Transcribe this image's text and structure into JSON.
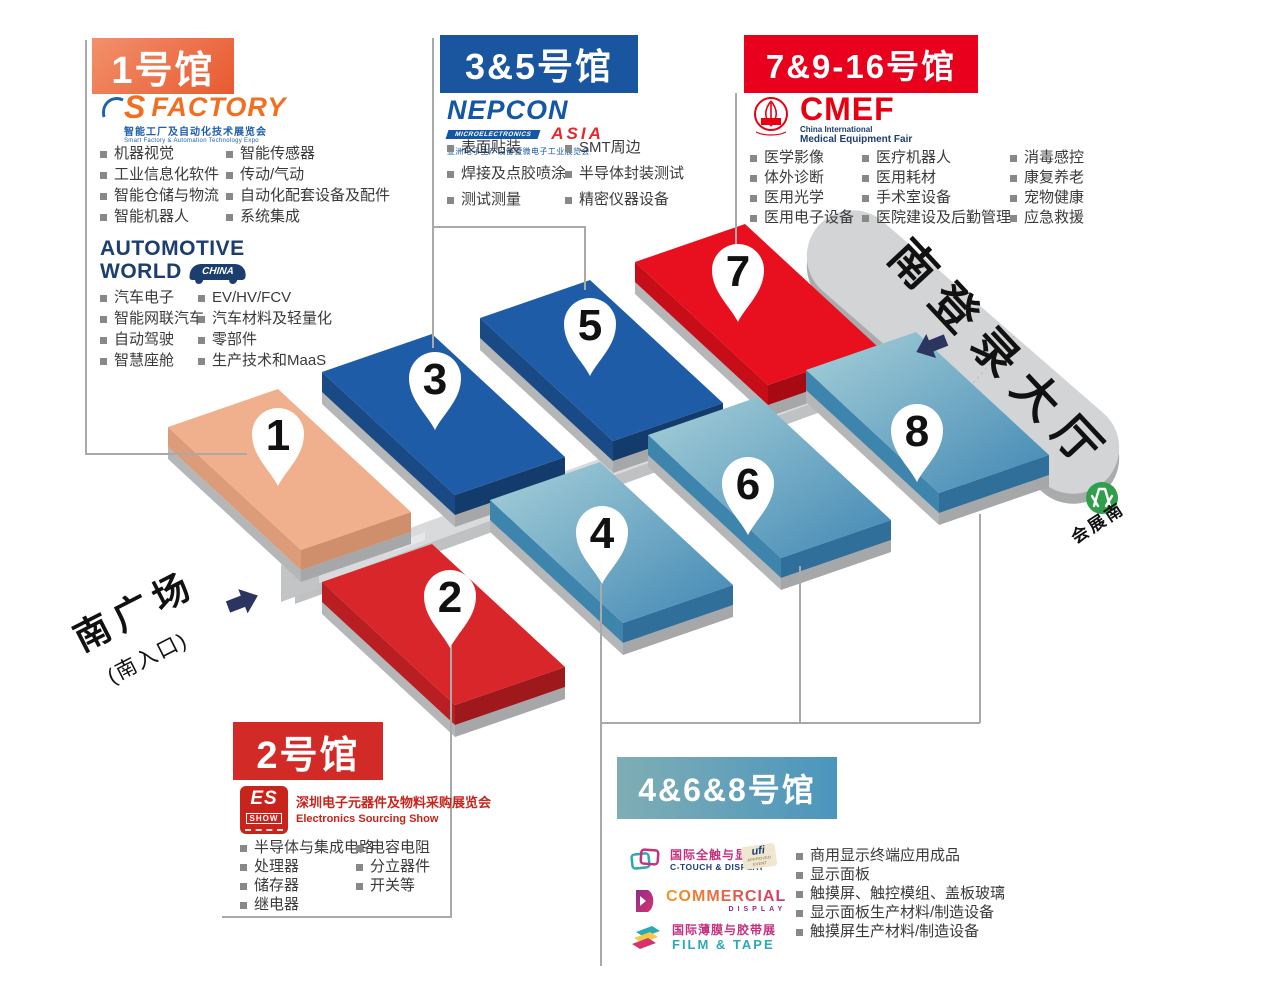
{
  "colors": {
    "hall1_accent": "#ED6A3E",
    "hall35_accent": "#1A55A0",
    "hall7916_accent": "#E8001C",
    "hall2_accent": "#D22A26",
    "hall468_accent": "#4B95BD",
    "hall1_block": "#F0B08D",
    "hall2_block": "#D8262B",
    "hall35_block": "#1F5CA7",
    "hall7_block": "#E8101E",
    "hall468_block": "#4187B4",
    "lobby_gray": "#D3D4D6",
    "metro_green": "#2F9E4D"
  },
  "map": {
    "pins": [
      "1",
      "2",
      "3",
      "4",
      "5",
      "6",
      "7",
      "8"
    ],
    "lobby_label": "南登录大厅",
    "plaza_label": "南广场",
    "plaza_sub_label": "(南入口)",
    "metro_label": "会展南"
  },
  "hall1": {
    "header": "1号馆",
    "sfactory": {
      "logo_s": "S",
      "logo_factory": "FACTORY",
      "sub_cn": "智能工厂及自动化技术展览会",
      "sub_en": "Smart Factory & Automation Technology Expo",
      "left": [
        "机器视觉",
        "工业信息化软件",
        "智能仓储与物流",
        "智能机器人"
      ],
      "right": [
        "智能传感器",
        "传动/气动",
        "自动化配套设备及配件",
        "系统集成"
      ]
    },
    "automotive": {
      "line1": "AUTOMOTIVE",
      "line2": "WORLD",
      "badge": "CHINA",
      "left": [
        "汽车电子",
        "智能网联汽车",
        "自动驾驶",
        "智慧座舱"
      ],
      "right": [
        "EV/HV/FCV",
        "汽车材料及轻量化",
        "零部件",
        "生产技术和MaaS"
      ]
    }
  },
  "hall35": {
    "header": "3&5号馆",
    "nepcon": {
      "name": "NEPCON",
      "band": "MICROELECTRONICS",
      "asia": "ASIA",
      "sub_cn": "亚洲电子生产设备暨微电子工业展览会"
    },
    "left": [
      "表面贴装",
      "焊接及点胶喷涂",
      "测试测量"
    ],
    "right": [
      "SMT周边",
      "半导体封装测试",
      "精密仪器设备"
    ]
  },
  "hall7916": {
    "header": "7&9-16号馆",
    "cmef": {
      "name": "CMEF",
      "sub1": "China International",
      "sub2": "Medical Equipment Fair"
    },
    "col1": [
      "医学影像",
      "体外诊断",
      "医用光学",
      "医用电子设备"
    ],
    "col2": [
      "医疗机器人",
      "医用耗材",
      "手术室设备",
      "医院建设及后勤管理"
    ],
    "col3": [
      "消毒感控",
      "康复养老",
      "宠物健康",
      "应急救援"
    ]
  },
  "hall2": {
    "header": "2号馆",
    "es": {
      "abbr": "ES",
      "show": "SHOW",
      "cn": "深圳电子元器件及物料采购展览会",
      "en": "Electronics Sourcing Show"
    },
    "left": [
      "半导体与集成电路",
      "处理器",
      "储存器",
      "继电器"
    ],
    "right": [
      "电容电阻",
      "分立器件",
      "开关等"
    ]
  },
  "hall468": {
    "header": "4&6&8号馆",
    "ctouch": {
      "cn": "国际全触与显示展",
      "en": "C-TOUCH & DISPLAY"
    },
    "ufi": {
      "name": "ufi",
      "sub": "APPROVED EVENT"
    },
    "commercial": {
      "name": "COMMERCIAL",
      "sub": "DISPLAY"
    },
    "film": {
      "cn": "国际薄膜与胶带展",
      "en": "FILM & TAPE"
    },
    "items": [
      "商用显示终端应用成品",
      "显示面板",
      "触摸屏、触控模组、盖板玻璃",
      "显示面板生产材料/制造设备",
      "触摸屏生产材料/制造设备"
    ]
  }
}
